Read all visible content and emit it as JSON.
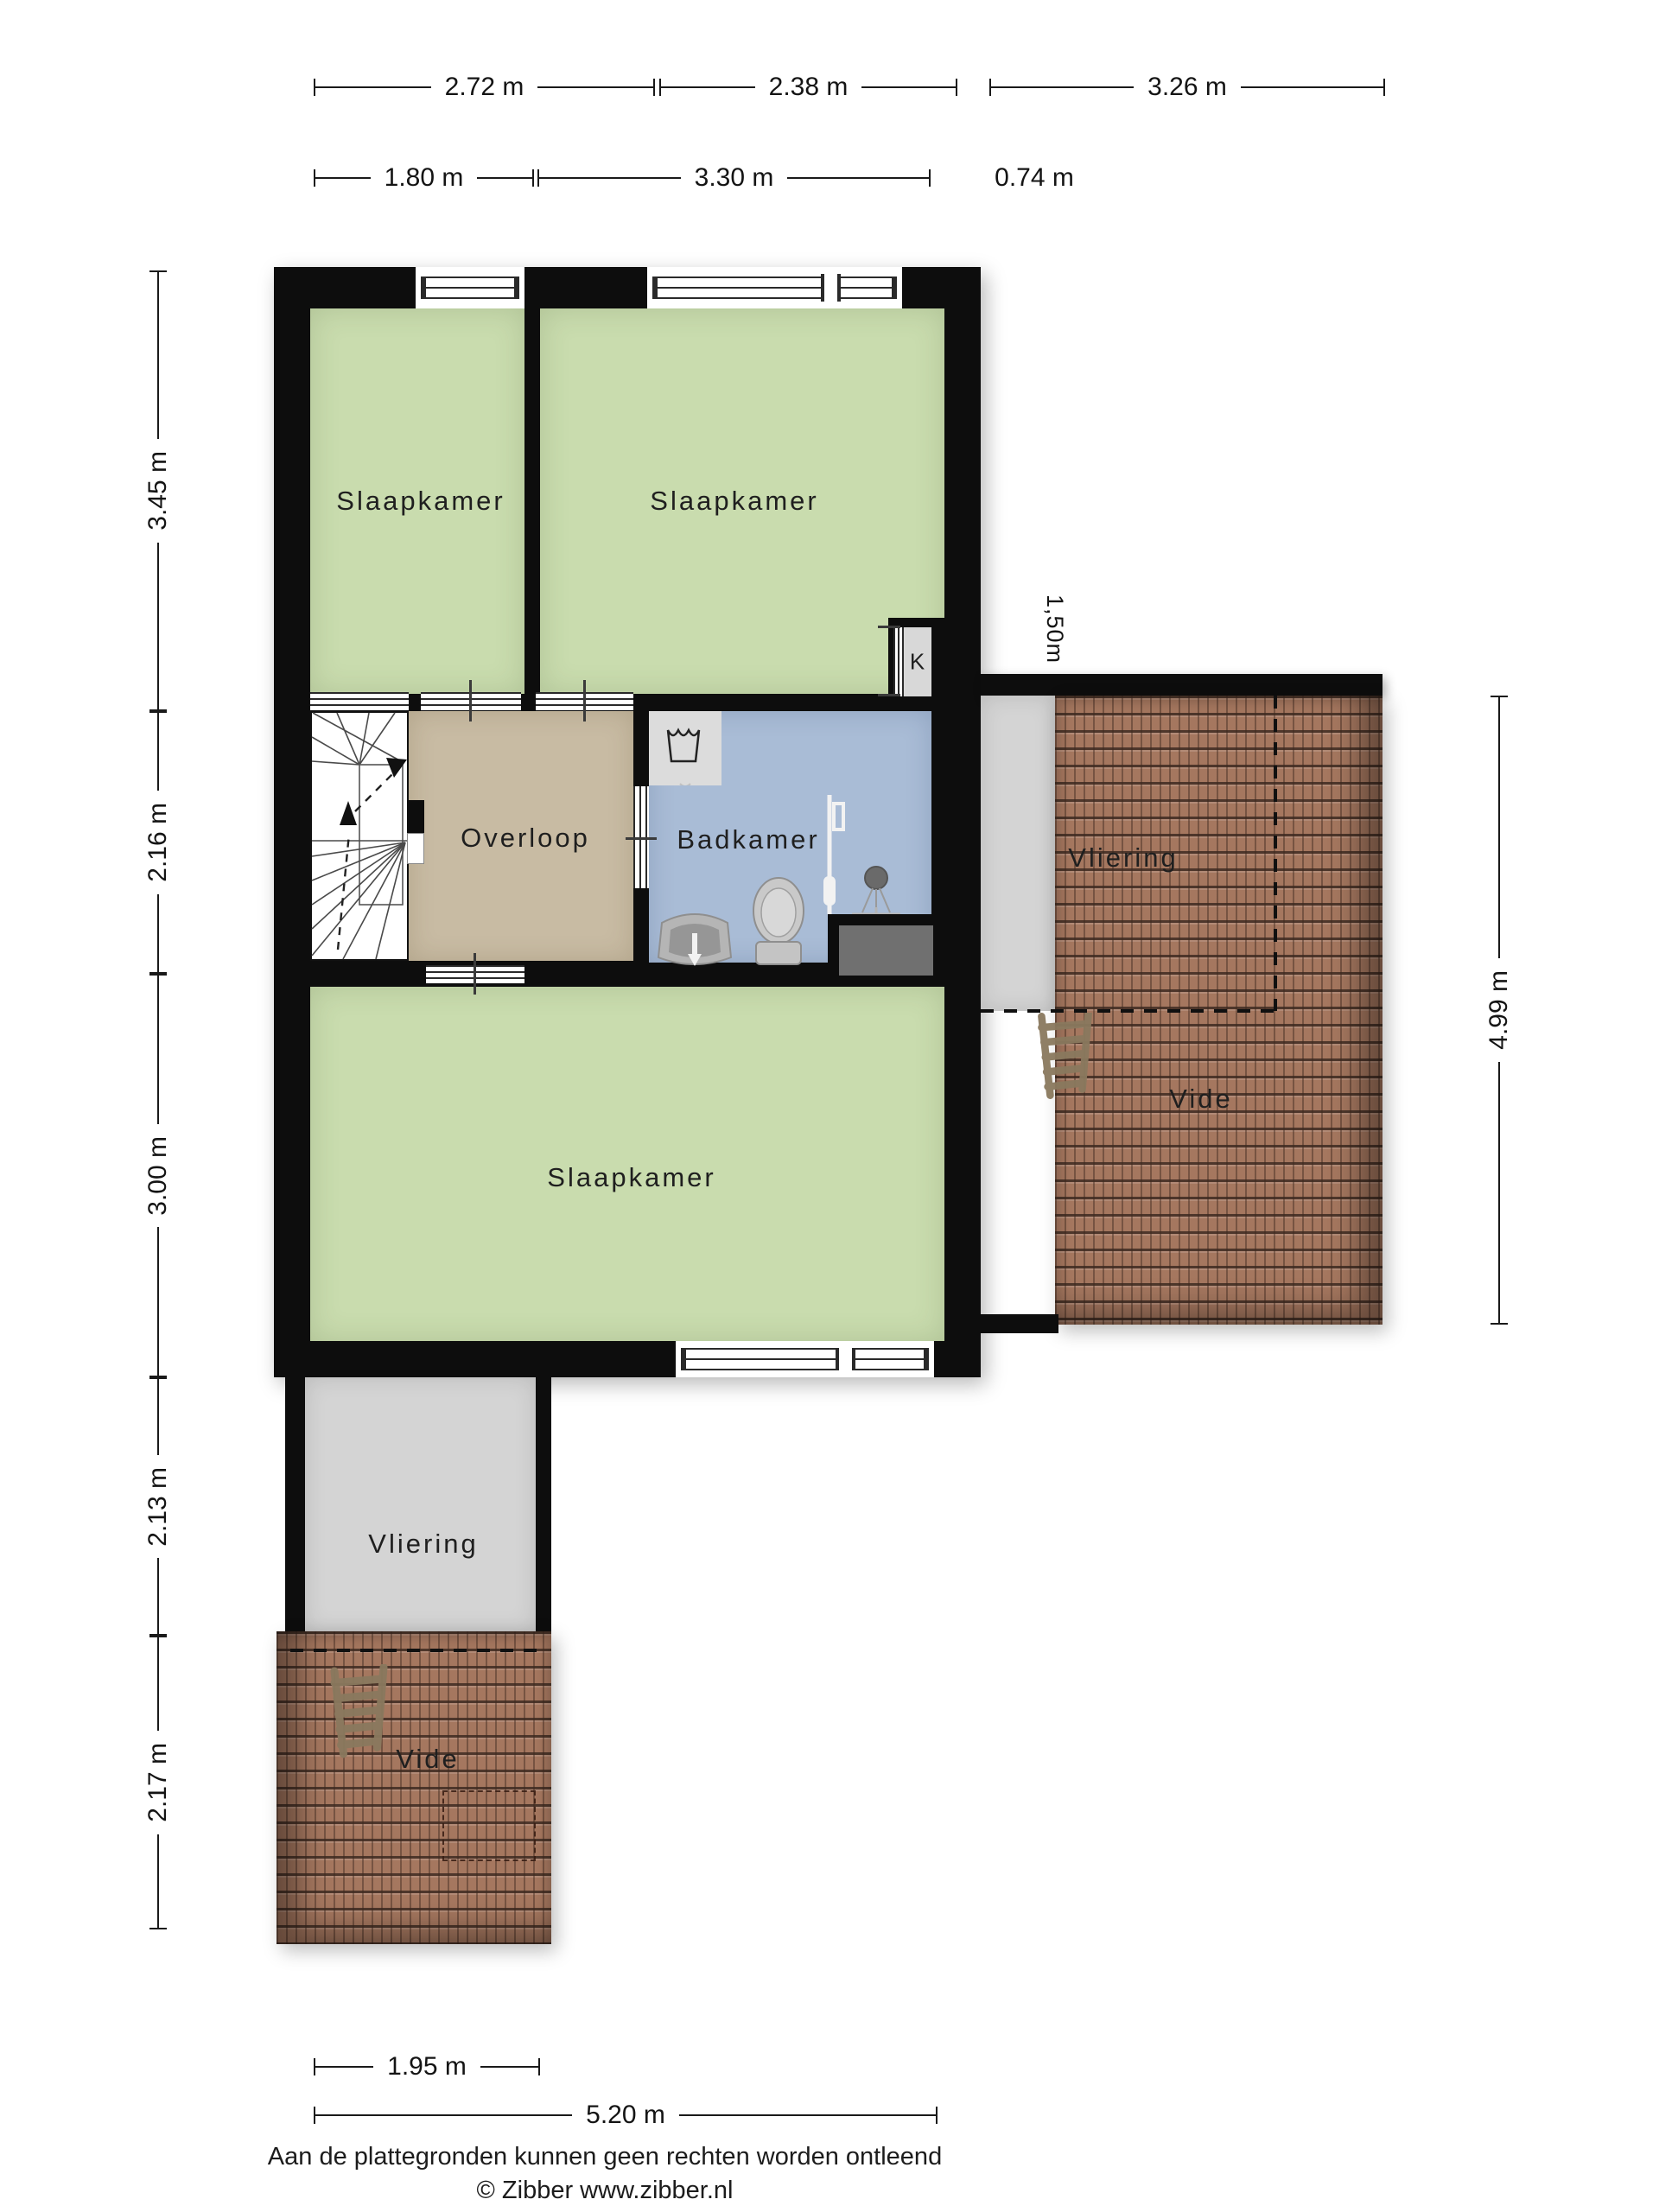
{
  "dimensions": {
    "top_row1": [
      "2.72 m",
      "2.38 m",
      "3.26 m"
    ],
    "top_row2": [
      "1.80 m",
      "3.30 m",
      "0.74 m"
    ],
    "left": [
      "3.45 m",
      "2.16 m",
      "3.00 m",
      "2.13 m",
      "2.17 m"
    ],
    "right": [
      "4.99 m"
    ],
    "bottom": [
      "1.95 m",
      "5.20 m"
    ],
    "headroom_annotation": "1,50m"
  },
  "rooms": {
    "bedroom_top_left": "Slaapkamer",
    "bedroom_top_right": "Slaapkamer",
    "bedroom_bottom": "Slaapkamer",
    "landing": "Overloop",
    "bathroom": "Badkamer",
    "closet": "K",
    "attic_right": "Vliering",
    "void_right": "Vide",
    "attic_bottom_left": "Vliering",
    "void_bottom_left": "Vide"
  },
  "footer": {
    "disclaimer": "Aan de plattegronden kunnen geen rechten worden ontleend",
    "copyright": "© Zibber www.zibber.nl"
  },
  "colors": {
    "wall": "#0d0d0d",
    "bedroom_fill": "#c9dcae",
    "landing_fill": "#c8bba3",
    "bathroom_fill": "#a9bcd6",
    "attic_fill": "#d4d4d4",
    "roof_tile": "#a5775f",
    "roof_tile_line": "#3e281e",
    "shower_tray": "#707070",
    "ladder": "#8a795e"
  },
  "icons": {
    "stairs": "winder-staircase with walk-line arrows",
    "ladder": "loft-ladder",
    "washing_machine": "laundry-tub glyph",
    "toilet": "toilet top view",
    "sink": "washbasin top view",
    "shower": "shower head and rail"
  }
}
